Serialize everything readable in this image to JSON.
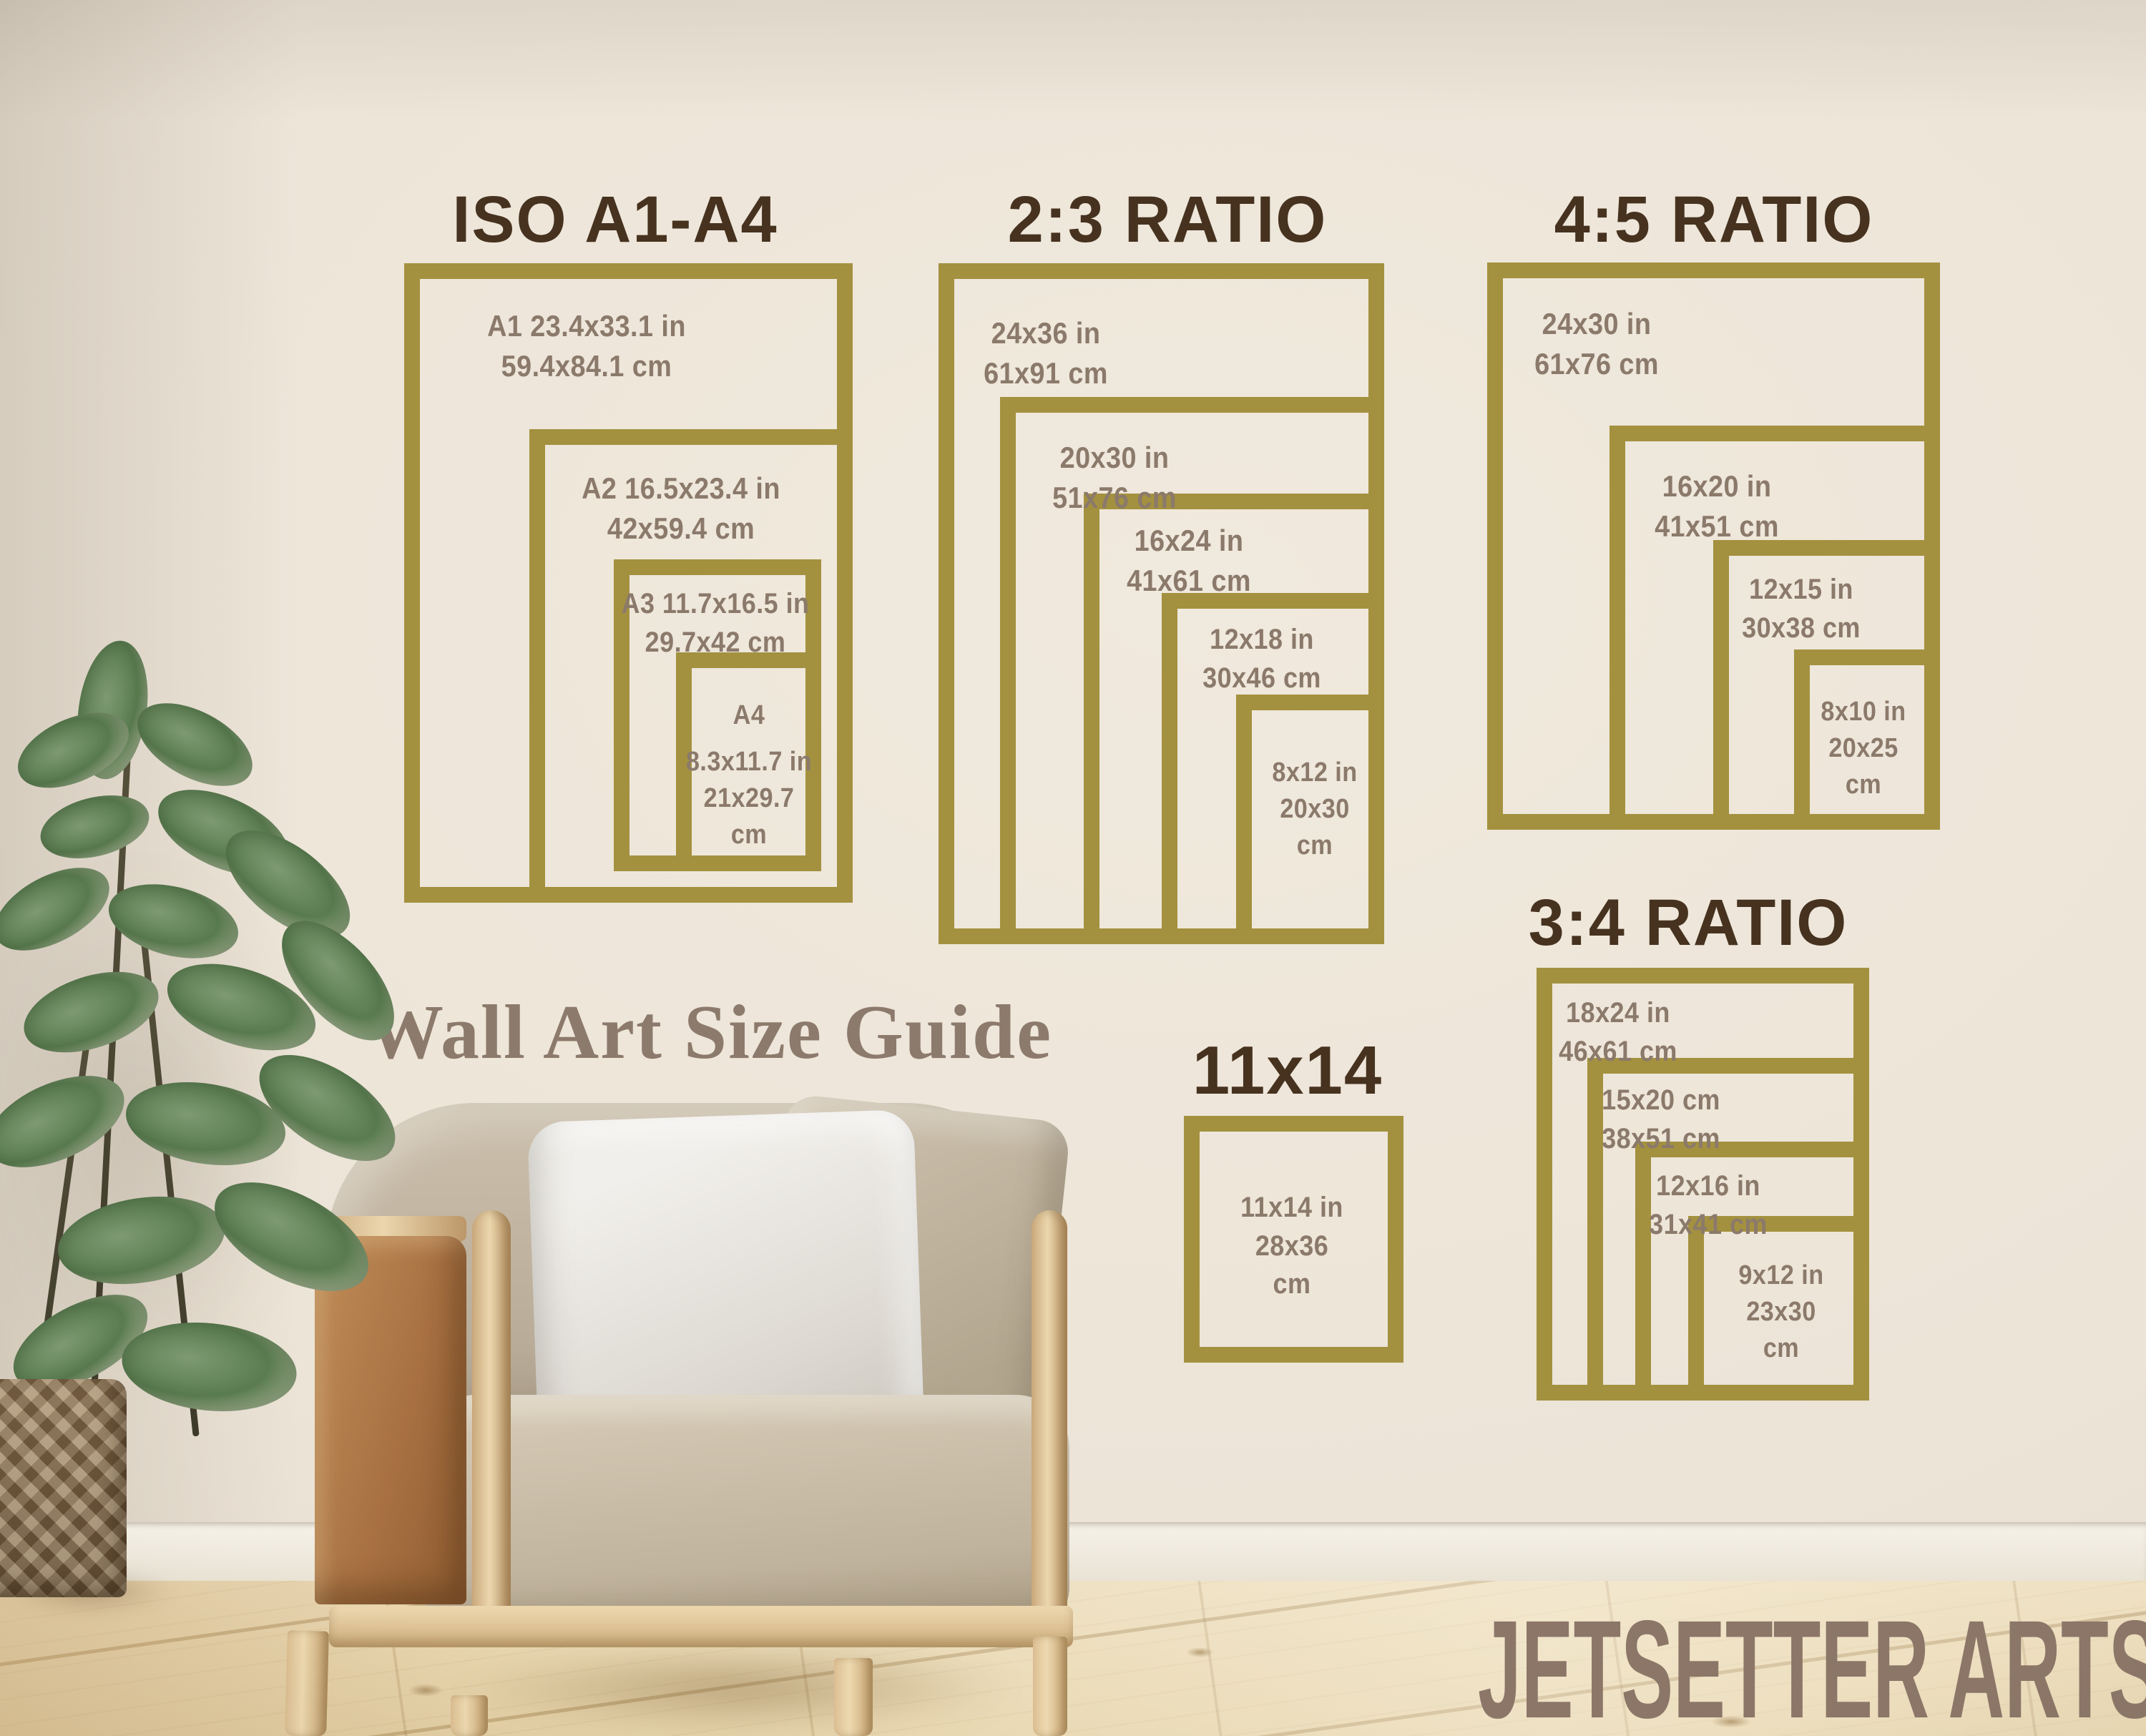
{
  "overlay": {
    "guide_title": "Wall Art Size Guide",
    "brand": "JETSETTER ARTS"
  },
  "sections": {
    "iso": {
      "title": "ISO A1-A4",
      "boxes": [
        {
          "id": "a1",
          "lines": [
            "A1 23.4x33.1 in",
            "59.4x84.1 cm"
          ]
        },
        {
          "id": "a2",
          "lines": [
            "A2 16.5x23.4 in",
            "42x59.4 cm"
          ]
        },
        {
          "id": "a3",
          "lines": [
            "A3 11.7x16.5 in",
            "29.7x42 cm"
          ]
        },
        {
          "id": "a4",
          "lines": [
            "A4",
            "8.3x11.7 in",
            "21x29.7",
            "cm"
          ]
        }
      ]
    },
    "ratio_2_3": {
      "title": "2:3 RATIO",
      "boxes": [
        {
          "id": "24x36",
          "lines": [
            "24x36 in",
            "61x91 cm"
          ]
        },
        {
          "id": "20x30",
          "lines": [
            "20x30 in",
            "51x76 cm"
          ]
        },
        {
          "id": "16x24",
          "lines": [
            "16x24 in",
            "41x61 cm"
          ]
        },
        {
          "id": "12x18",
          "lines": [
            "12x18 in",
            "30x46 cm"
          ]
        },
        {
          "id": "8x12",
          "lines": [
            "8x12 in",
            "20x30",
            "cm"
          ]
        }
      ]
    },
    "ratio_4_5": {
      "title": "4:5 RATIO",
      "boxes": [
        {
          "id": "24x30",
          "lines": [
            "24x30 in",
            "61x76 cm"
          ]
        },
        {
          "id": "16x20",
          "lines": [
            "16x20 in",
            "41x51 cm"
          ]
        },
        {
          "id": "12x15",
          "lines": [
            "12x15 in",
            "30x38 cm"
          ]
        },
        {
          "id": "8x10",
          "lines": [
            "8x10 in",
            "20x25",
            "cm"
          ]
        }
      ]
    },
    "ratio_3_4": {
      "title": "3:4 RATIO",
      "boxes": [
        {
          "id": "18x24",
          "lines": [
            "18x24 in",
            "46x61 cm"
          ]
        },
        {
          "id": "15x20",
          "lines": [
            "15x20 cm",
            "38x51 cm"
          ]
        },
        {
          "id": "12x16",
          "lines": [
            "12x16 in",
            "31x41 cm"
          ]
        },
        {
          "id": "9x12",
          "lines": [
            "9x12 in",
            "23x30",
            "cm"
          ]
        }
      ]
    },
    "size_11x14": {
      "title": "11x14",
      "boxes": [
        {
          "id": "11x14",
          "lines": [
            "11x14 in",
            "28x36",
            "cm"
          ]
        }
      ]
    }
  },
  "colors": {
    "gold_frame": "#a3913f",
    "section_title_text": "#46321f",
    "dimension_text": "#8b7a6b",
    "wall": "#ebe3d6",
    "guide_title_text": "#8c7a6c",
    "brand_text": "#8c7668",
    "floor_wood": "#e9d8b4",
    "chair_fabric": "#c4b8a4",
    "chair_leather": "#a87142",
    "chair_wood": "#dcbf92",
    "plant_green": "#5a7c50",
    "basket_wicker": "#8d7355"
  }
}
